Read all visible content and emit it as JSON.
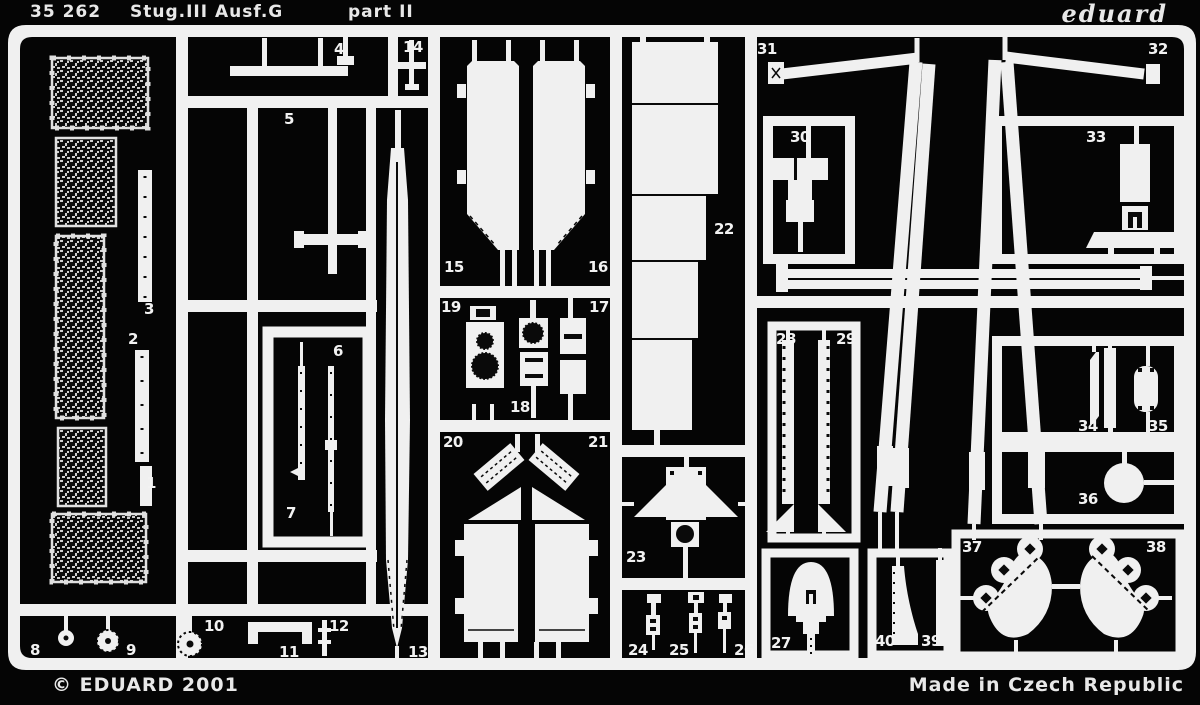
{
  "sheet": {
    "colors": {
      "background": "#050505",
      "metal": "#f0f0f0"
    },
    "header": {
      "catalog_number": "35 262",
      "title": "Stug.III Ausf.G",
      "subtitle": "part II",
      "brand_logo": "eduard"
    },
    "footer": {
      "copyright": "© EDUARD 2001",
      "made_in": "Made in Czech Republic"
    },
    "part_labels": [
      {
        "n": "1",
        "x": 146,
        "y": 476
      },
      {
        "n": "2",
        "x": 128,
        "y": 332
      },
      {
        "n": "3",
        "x": 144,
        "y": 302
      },
      {
        "n": "4",
        "x": 334,
        "y": 42
      },
      {
        "n": "5",
        "x": 284,
        "y": 112
      },
      {
        "n": "6",
        "x": 333,
        "y": 344
      },
      {
        "n": "7",
        "x": 286,
        "y": 506
      },
      {
        "n": "8",
        "x": 30,
        "y": 643
      },
      {
        "n": "9",
        "x": 126,
        "y": 643
      },
      {
        "n": "10",
        "x": 204,
        "y": 619
      },
      {
        "n": "11",
        "x": 279,
        "y": 645
      },
      {
        "n": "12",
        "x": 329,
        "y": 619
      },
      {
        "n": "13",
        "x": 408,
        "y": 645
      },
      {
        "n": "14",
        "x": 403,
        "y": 40
      },
      {
        "n": "15",
        "x": 444,
        "y": 260
      },
      {
        "n": "16",
        "x": 588,
        "y": 260
      },
      {
        "n": "17",
        "x": 589,
        "y": 300
      },
      {
        "n": "18",
        "x": 510,
        "y": 400
      },
      {
        "n": "19",
        "x": 441,
        "y": 300
      },
      {
        "n": "20",
        "x": 443,
        "y": 435
      },
      {
        "n": "21",
        "x": 588,
        "y": 435
      },
      {
        "n": "22",
        "x": 714,
        "y": 222
      },
      {
        "n": "23",
        "x": 626,
        "y": 550
      },
      {
        "n": "24",
        "x": 628,
        "y": 643
      },
      {
        "n": "25",
        "x": 669,
        "y": 643
      },
      {
        "n": "26",
        "x": 734,
        "y": 643
      },
      {
        "n": "27",
        "x": 771,
        "y": 636
      },
      {
        "n": "28",
        "x": 776,
        "y": 332
      },
      {
        "n": "29",
        "x": 836,
        "y": 332
      },
      {
        "n": "30",
        "x": 790,
        "y": 130
      },
      {
        "n": "31",
        "x": 757,
        "y": 42
      },
      {
        "n": "32",
        "x": 1148,
        "y": 42
      },
      {
        "n": "33",
        "x": 1086,
        "y": 130
      },
      {
        "n": "34",
        "x": 1078,
        "y": 419
      },
      {
        "n": "35",
        "x": 1148,
        "y": 419
      },
      {
        "n": "36",
        "x": 1078,
        "y": 492
      },
      {
        "n": "37",
        "x": 962,
        "y": 540
      },
      {
        "n": "38",
        "x": 1146,
        "y": 540
      },
      {
        "n": "39",
        "x": 921,
        "y": 634
      },
      {
        "n": "40",
        "x": 875,
        "y": 634
      }
    ]
  }
}
